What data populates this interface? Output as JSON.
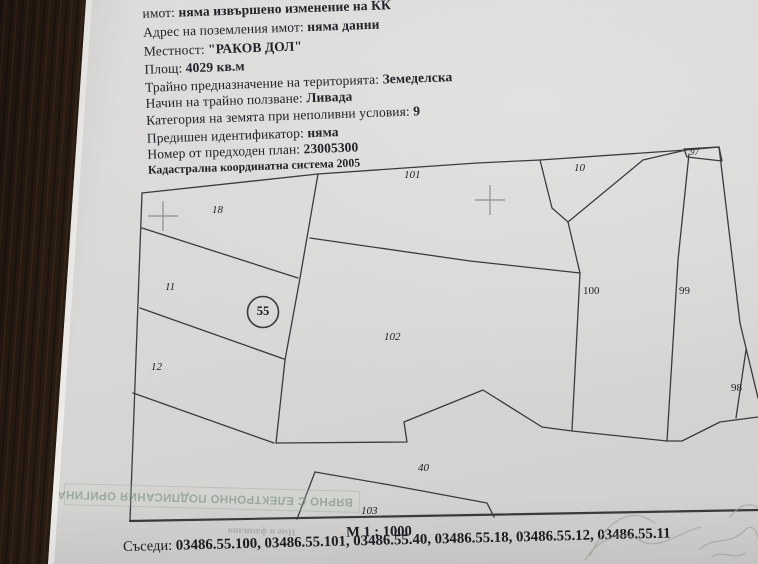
{
  "document": {
    "lines": [
      {
        "label": "Послед",
        "value": ""
      },
      {
        "label": "имот: ",
        "value": "няма извършено изменение на КК"
      },
      {
        "label": "Адрес на поземления имот: ",
        "value": "няма данни"
      },
      {
        "label": "Местност: ",
        "value": "\"РАКОВ ДОЛ\""
      },
      {
        "label": "Площ: ",
        "value": "4029 кв.м"
      },
      {
        "label": "Трайно предназначение на територията: ",
        "value": "Земеделска"
      },
      {
        "label": "Начин на трайно ползване: ",
        "value": "Ливада"
      },
      {
        "label": "Категория на земята при неполивни условия: ",
        "value": "9"
      },
      {
        "label": "Предишен идентификатор: ",
        "value": "няма"
      },
      {
        "label": "Номер от предходен план: ",
        "value": "23005300"
      },
      {
        "label": "Кадастрална координатна система 2005",
        "value": ""
      }
    ]
  },
  "map": {
    "subject_parcel": "55",
    "scale": "М 1 : 1000",
    "parcels": [
      {
        "id": "18"
      },
      {
        "id": "11"
      },
      {
        "id": "12"
      },
      {
        "id": "101"
      },
      {
        "id": "10"
      },
      {
        "id": "102"
      },
      {
        "id": "100"
      },
      {
        "id": "99"
      },
      {
        "id": "98"
      },
      {
        "id": "97"
      },
      {
        "id": "40"
      },
      {
        "id": "103"
      }
    ]
  },
  "footer": {
    "neighbors_label": "Съседи: ",
    "neighbors_value": "03486.55.100, 03486.55.101, 03486.55.40, 03486.55.18, 03486.55.12, 03486.55.11"
  },
  "stamp": {
    "text": "ВЯРНО С ЕЛЕКТРОННО ПОДПИСАНИЯ ОРИГИНАЛ"
  },
  "bleedthrough": {
    "text": "Име и фамилия"
  },
  "colors": {
    "paper": "#d9d8d6",
    "wood": "#332416",
    "ink": "#23222a",
    "stamp_green": "#788e7a"
  }
}
